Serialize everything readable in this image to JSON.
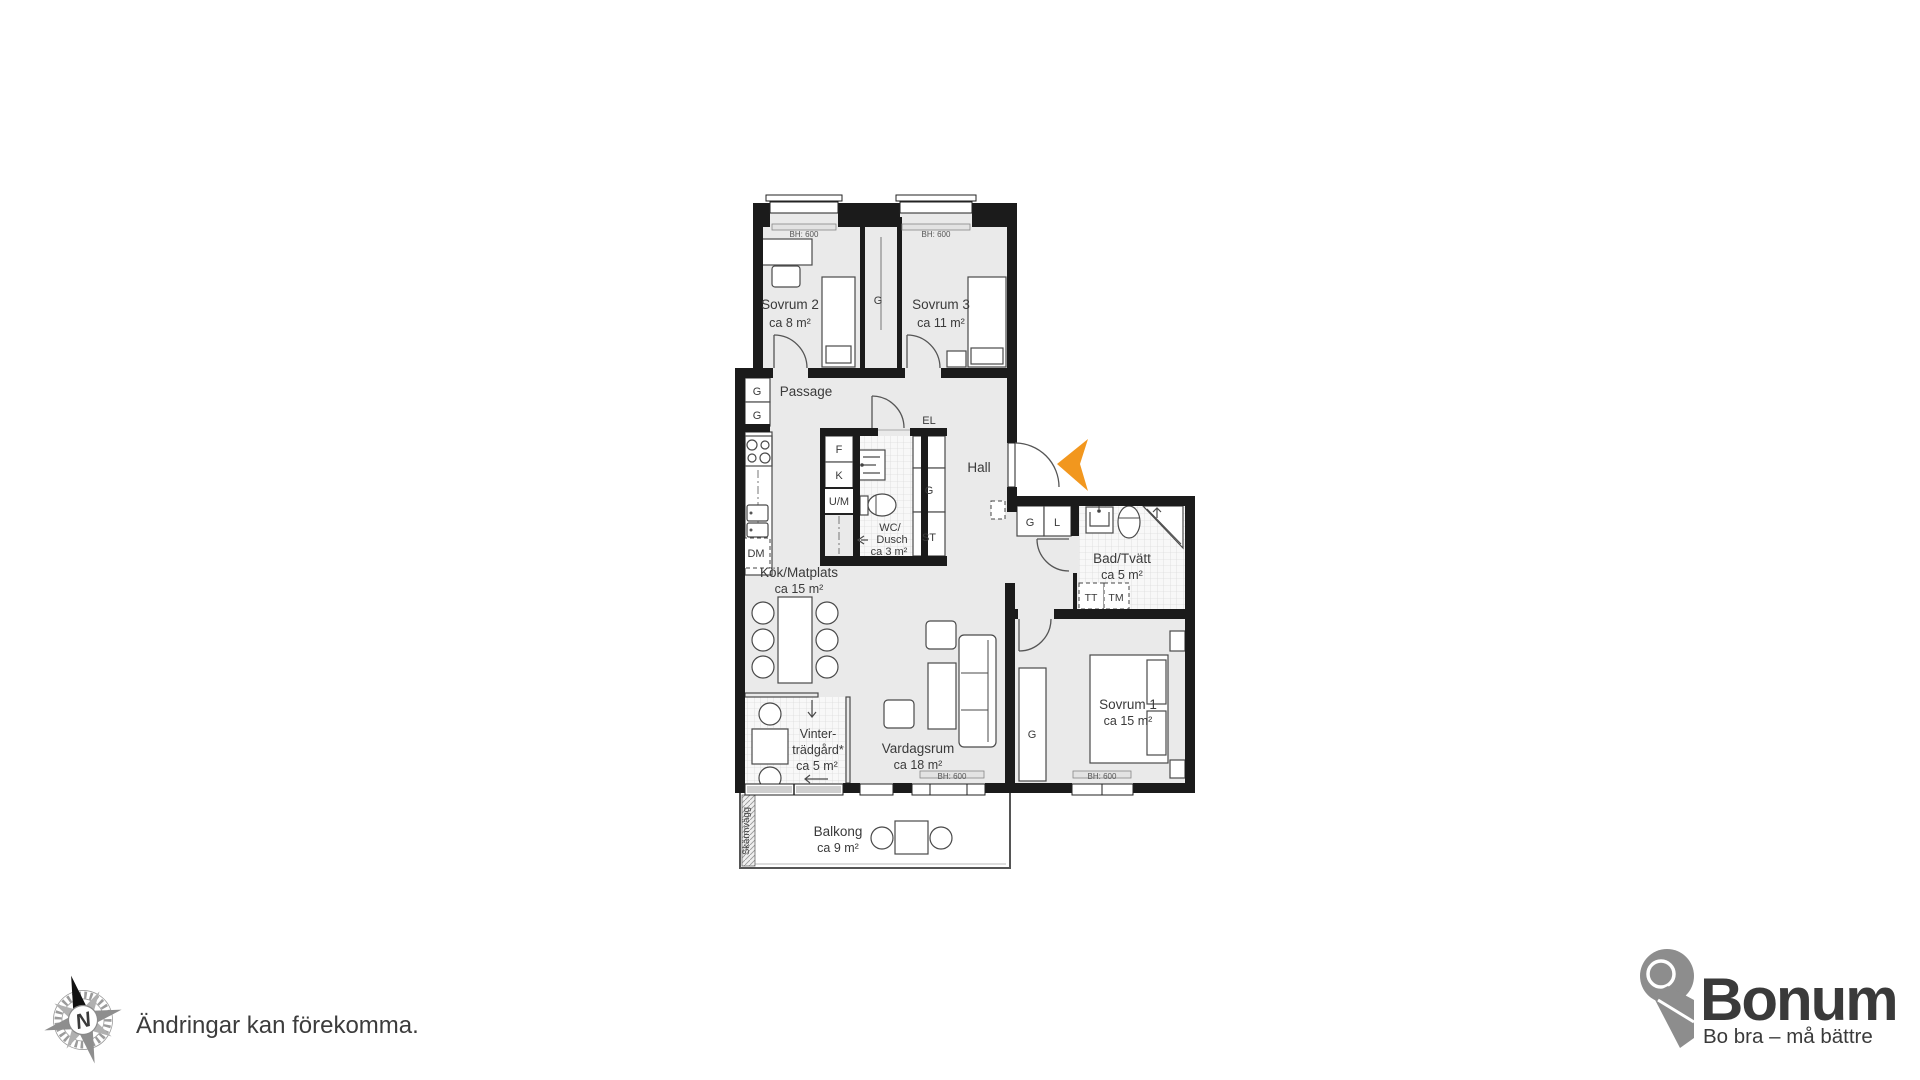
{
  "plan": {
    "rooms": {
      "sovrum2": {
        "name": "Sovrum 2",
        "area": "ca 8 m²"
      },
      "sovrum3": {
        "name": "Sovrum 3",
        "area": "ca 11 m²"
      },
      "sovrum1": {
        "name": "Sovrum 1",
        "area": "ca 15 m²"
      },
      "passage": {
        "name": "Passage"
      },
      "hall": {
        "name": "Hall"
      },
      "wc_dusch": {
        "name_line1": "WC/",
        "name_line2": "Dusch",
        "area": "ca 3 m²"
      },
      "kok": {
        "name": "Kök/Matplats",
        "area": "ca 15 m²"
      },
      "bad_tvatt": {
        "name": "Bad/Tvätt",
        "area": "ca 5 m²"
      },
      "vintertradgard": {
        "name_line1": "Vinter-",
        "name_line2": "trädgård*",
        "area": "ca 5 m²"
      },
      "vardagsrum": {
        "name": "Vardagsrum",
        "area": "ca 18 m²"
      },
      "balkong": {
        "name": "Balkong",
        "area": "ca 9 m²"
      }
    },
    "fixtures": {
      "g": "G",
      "l": "L",
      "st": "ST",
      "el": "EL",
      "f": "F",
      "k": "K",
      "um": "U/M",
      "dm": "DM",
      "tt": "TT",
      "tm": "TM"
    },
    "window_height_label": "BH: 600",
    "screen_wall_label": "Skärmvägg",
    "colors": {
      "wall": "#1b1b1b",
      "room_fill": "#eaeaea",
      "accent_orange": "#f2971e"
    }
  },
  "footer": {
    "disclaimer": "Ändringar kan förekomma.",
    "compass_letter": "N"
  },
  "brand": {
    "name": "Bonum",
    "tagline": "Bo bra – må bättre",
    "orange": "#ef8a1f",
    "gray": "#8a8a8a"
  }
}
